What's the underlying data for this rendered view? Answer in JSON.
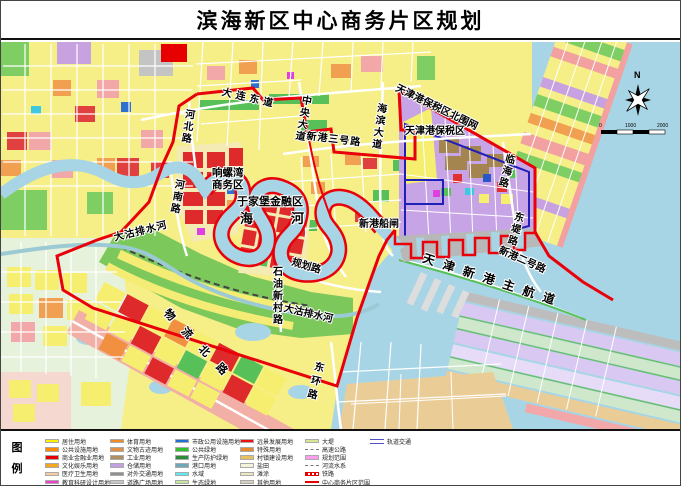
{
  "title": "滨海新区中心商务片区规划",
  "compass": {
    "north": "N"
  },
  "scale": {
    "t0": "0",
    "t1": "1000",
    "t2": "2000"
  },
  "map_labels": {
    "dalian_east_rd": "大连东道",
    "central_ave": "中央大道",
    "xingang_rd3": "新港三号路",
    "haibin_ave": "海滨大道",
    "btz_north_fence": "天津港保税区北围网",
    "btz": "天津港保税区",
    "linhai_rd": "临海路",
    "dongdi_rd": "东堤路",
    "xingang_rd2": "新港二号路",
    "main_channel": "天津新港主航道",
    "xingang_lock": "新港船闸",
    "hebei_rd": "河北路",
    "henan_rd": "河南路",
    "xiangluowan_line1": "响螺湾",
    "xiangluowan_line2": "商务区",
    "yujiapu": "于家堡金融区",
    "haihe_hai": "海",
    "haihe_he": "河",
    "dagu_river_w": "大沽排水河",
    "dagu_river_e": "大沽排水河",
    "shiyou_xincun_rd": "石油新村路",
    "guihua_rd": "规划路",
    "wuliu_north_rd": "物流北路",
    "donghuan_rd": "东环路"
  },
  "legend": {
    "title_chars": [
      "图",
      "例"
    ],
    "columns": [
      [
        {
          "label": "居住用地",
          "color": "#FFF000",
          "type": "fill"
        },
        {
          "label": "公共设施用地",
          "color": "#FF8C00",
          "type": "fill"
        },
        {
          "label": "商业金融业用地",
          "color": "#E60000",
          "type": "fill"
        },
        {
          "label": "文化娱乐用地",
          "color": "#F5A623",
          "type": "fill"
        },
        {
          "label": "医疗卫生用地",
          "color": "#F8CBA0",
          "type": "fill"
        },
        {
          "label": "教育科研设计用地",
          "color": "#F040D0",
          "type": "fill"
        }
      ],
      [
        {
          "label": "体育用地",
          "color": "#F08C28",
          "type": "fill"
        },
        {
          "label": "文物古迹用地",
          "color": "#E09048",
          "type": "fill"
        },
        {
          "label": "工业用地",
          "color": "#B09060",
          "type": "fill"
        },
        {
          "label": "仓储用地",
          "color": "#C0A0E0",
          "type": "fill"
        },
        {
          "label": "对外交通用地",
          "color": "#909090",
          "type": "fill"
        },
        {
          "label": "道路广场用地",
          "color": "#C8C8C8",
          "type": "fill"
        }
      ],
      [
        {
          "label": "市政公用设施用地",
          "color": "#2070D0",
          "type": "fill"
        },
        {
          "label": "公共绿地",
          "color": "#30C030",
          "type": "fill"
        },
        {
          "label": "生产防护绿地",
          "color": "#2E8B3A",
          "type": "fill"
        },
        {
          "label": "港口用地",
          "color": "#70A8B8",
          "type": "fill"
        },
        {
          "label": "水域",
          "color": "#60E8F0",
          "type": "fill"
        },
        {
          "label": "生态绿地",
          "color": "#C8E8A0",
          "type": "fill"
        }
      ],
      [
        {
          "label": "远景发展用地",
          "color": "#F01010",
          "type": "fill"
        },
        {
          "label": "特殊用地",
          "color": "#E88830",
          "type": "fill"
        },
        {
          "label": "村镇建设用地",
          "color": "#E8C060",
          "type": "fill"
        },
        {
          "label": "盐田",
          "color": "#F6F2D8",
          "type": "fill"
        },
        {
          "label": "滩涂",
          "color": "#EFE6C0",
          "type": "fill"
        },
        {
          "label": "其他用地",
          "color": "#D8D0C0",
          "type": "fill"
        }
      ],
      [
        {
          "label": "大堤",
          "color": "#D8E890",
          "type": "fill"
        },
        {
          "label": "高速公路",
          "color": "#808080",
          "type": "dashed"
        },
        {
          "label": "规划范围",
          "color": "#FF9FEF",
          "type": "fill"
        },
        {
          "label": "河流水系",
          "color": "#8090A0",
          "type": "dashed"
        },
        {
          "label": "铁路",
          "color": "#E60000",
          "type": "rail"
        },
        {
          "label": "中心商务片区范围",
          "color": "#E60000",
          "type": "line"
        }
      ],
      [
        {
          "label": "轨道交通",
          "color": "#5050C8",
          "type": "double"
        }
      ]
    ]
  }
}
